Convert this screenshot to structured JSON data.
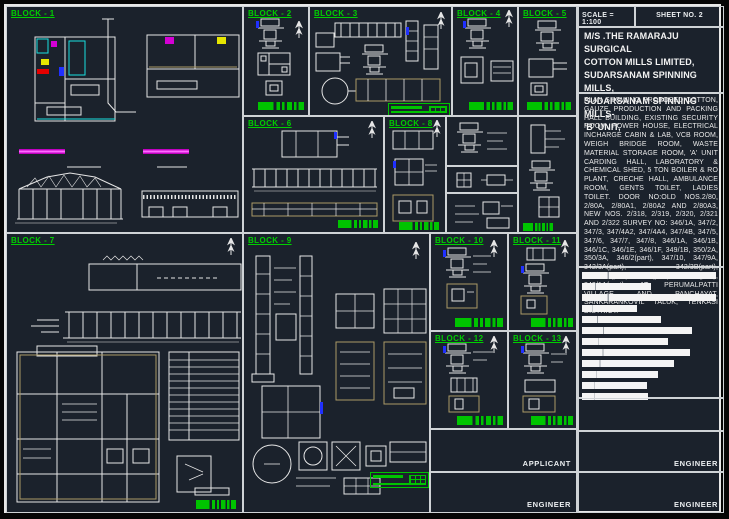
{
  "sheet": {
    "scale_label": "SCALE = 1:100",
    "sheet_no": "SHEET NO. 2"
  },
  "title_block": {
    "title_lines": "M/S .THE RAMARAJU SURGICAL\nCOTTON MILLS LIMITED,\nSUDARSANAM SPINNING MILLS,\nSUDARSANAM SPINNING MILLS-\n'B' UNIT,",
    "description": "PLAN SHOWING PROPOSED COTTON, GAUZE PRODUCTION AND PACKING HALL BUILDING, EXISTING SECURITY ROOM, POWER HOUSE, ELECTRICAL INCHARGE CABIN & LAB, VCB ROOM, WEIGH BRIDGE ROOM, WASTE MATERIAL STORAGE ROOM, 'A' UNIT CARDING HALL, LABORATORY & CHEMICAL SHED, 5 TON BOILER & RO PLANT, CRECHE HALL, AMBULANCE ROOM, GENTS TOILET, LADIES TOILET. DOOR NO:OLD NOS.2/80, 2/80A, 2/80A1, 2/80A2 AND 2/80A3, NEW NOS. 2/318, 2/319, 2/320, 2/321 AND 2/322 SURVEY NO: 346/1A, 347/2, 347/3, 347/4A2, 347/4A4, 347/4B, 347/5, 347/6, 347/7, 347/8, 346/1A, 346/1B, 346/1C, 346/1E, 346/1F, 349/1B, 350/2A, 350/3A, 346/2(part), 347/10, 347/9A, 342/3A(part), 342/3B(part), 347/4A1(part), 347/1(part), 346/1D(part), 349/1A(part) AT PERUMALPATTI VILLAGE AND PANCHAYAT, SANKARANKOVIL TALUK, TENKASI DISTRICT.",
    "table_rows": [
      97,
      50,
      97,
      40,
      57,
      80,
      62,
      78,
      67,
      55,
      47,
      48
    ],
    "signatures": [
      {
        "label": "APPLICANT"
      },
      {
        "label": "ENGINEER"
      },
      {
        "label": "ENGINEER"
      },
      {
        "label": "ENGINEER"
      }
    ]
  },
  "blocks": [
    {
      "label": "BLOCK - 1"
    },
    {
      "label": "BLOCK - 2"
    },
    {
      "label": "BLOCK - 3"
    },
    {
      "label": "BLOCK - 4"
    },
    {
      "label": "BLOCK - 5"
    },
    {
      "label": "BLOCK - 6"
    },
    {
      "label": "BLOCK - 7"
    },
    {
      "label": "BLOCK - 8"
    },
    {
      "label": "BLOCK - 9"
    },
    {
      "label": "BLOCK - 10"
    },
    {
      "label": "BLOCK - 11"
    },
    {
      "label": "BLOCK - 12"
    },
    {
      "label": "BLOCK - 13"
    }
  ],
  "icons": {
    "north_arrow": "north-arrow",
    "scale_bar": "graphic-scale-bar"
  },
  "colors": {
    "canvas": "#1b222c",
    "linework": "#e6e6e6",
    "block_label_green": "#00cf00",
    "scale_bar_green": "#00c400",
    "magenta": "#d400d4",
    "cyan": "#18e0e0",
    "yellow": "#e6e600",
    "red": "#e60000",
    "blue": "#2030ff",
    "tan": "#ab9a66"
  }
}
